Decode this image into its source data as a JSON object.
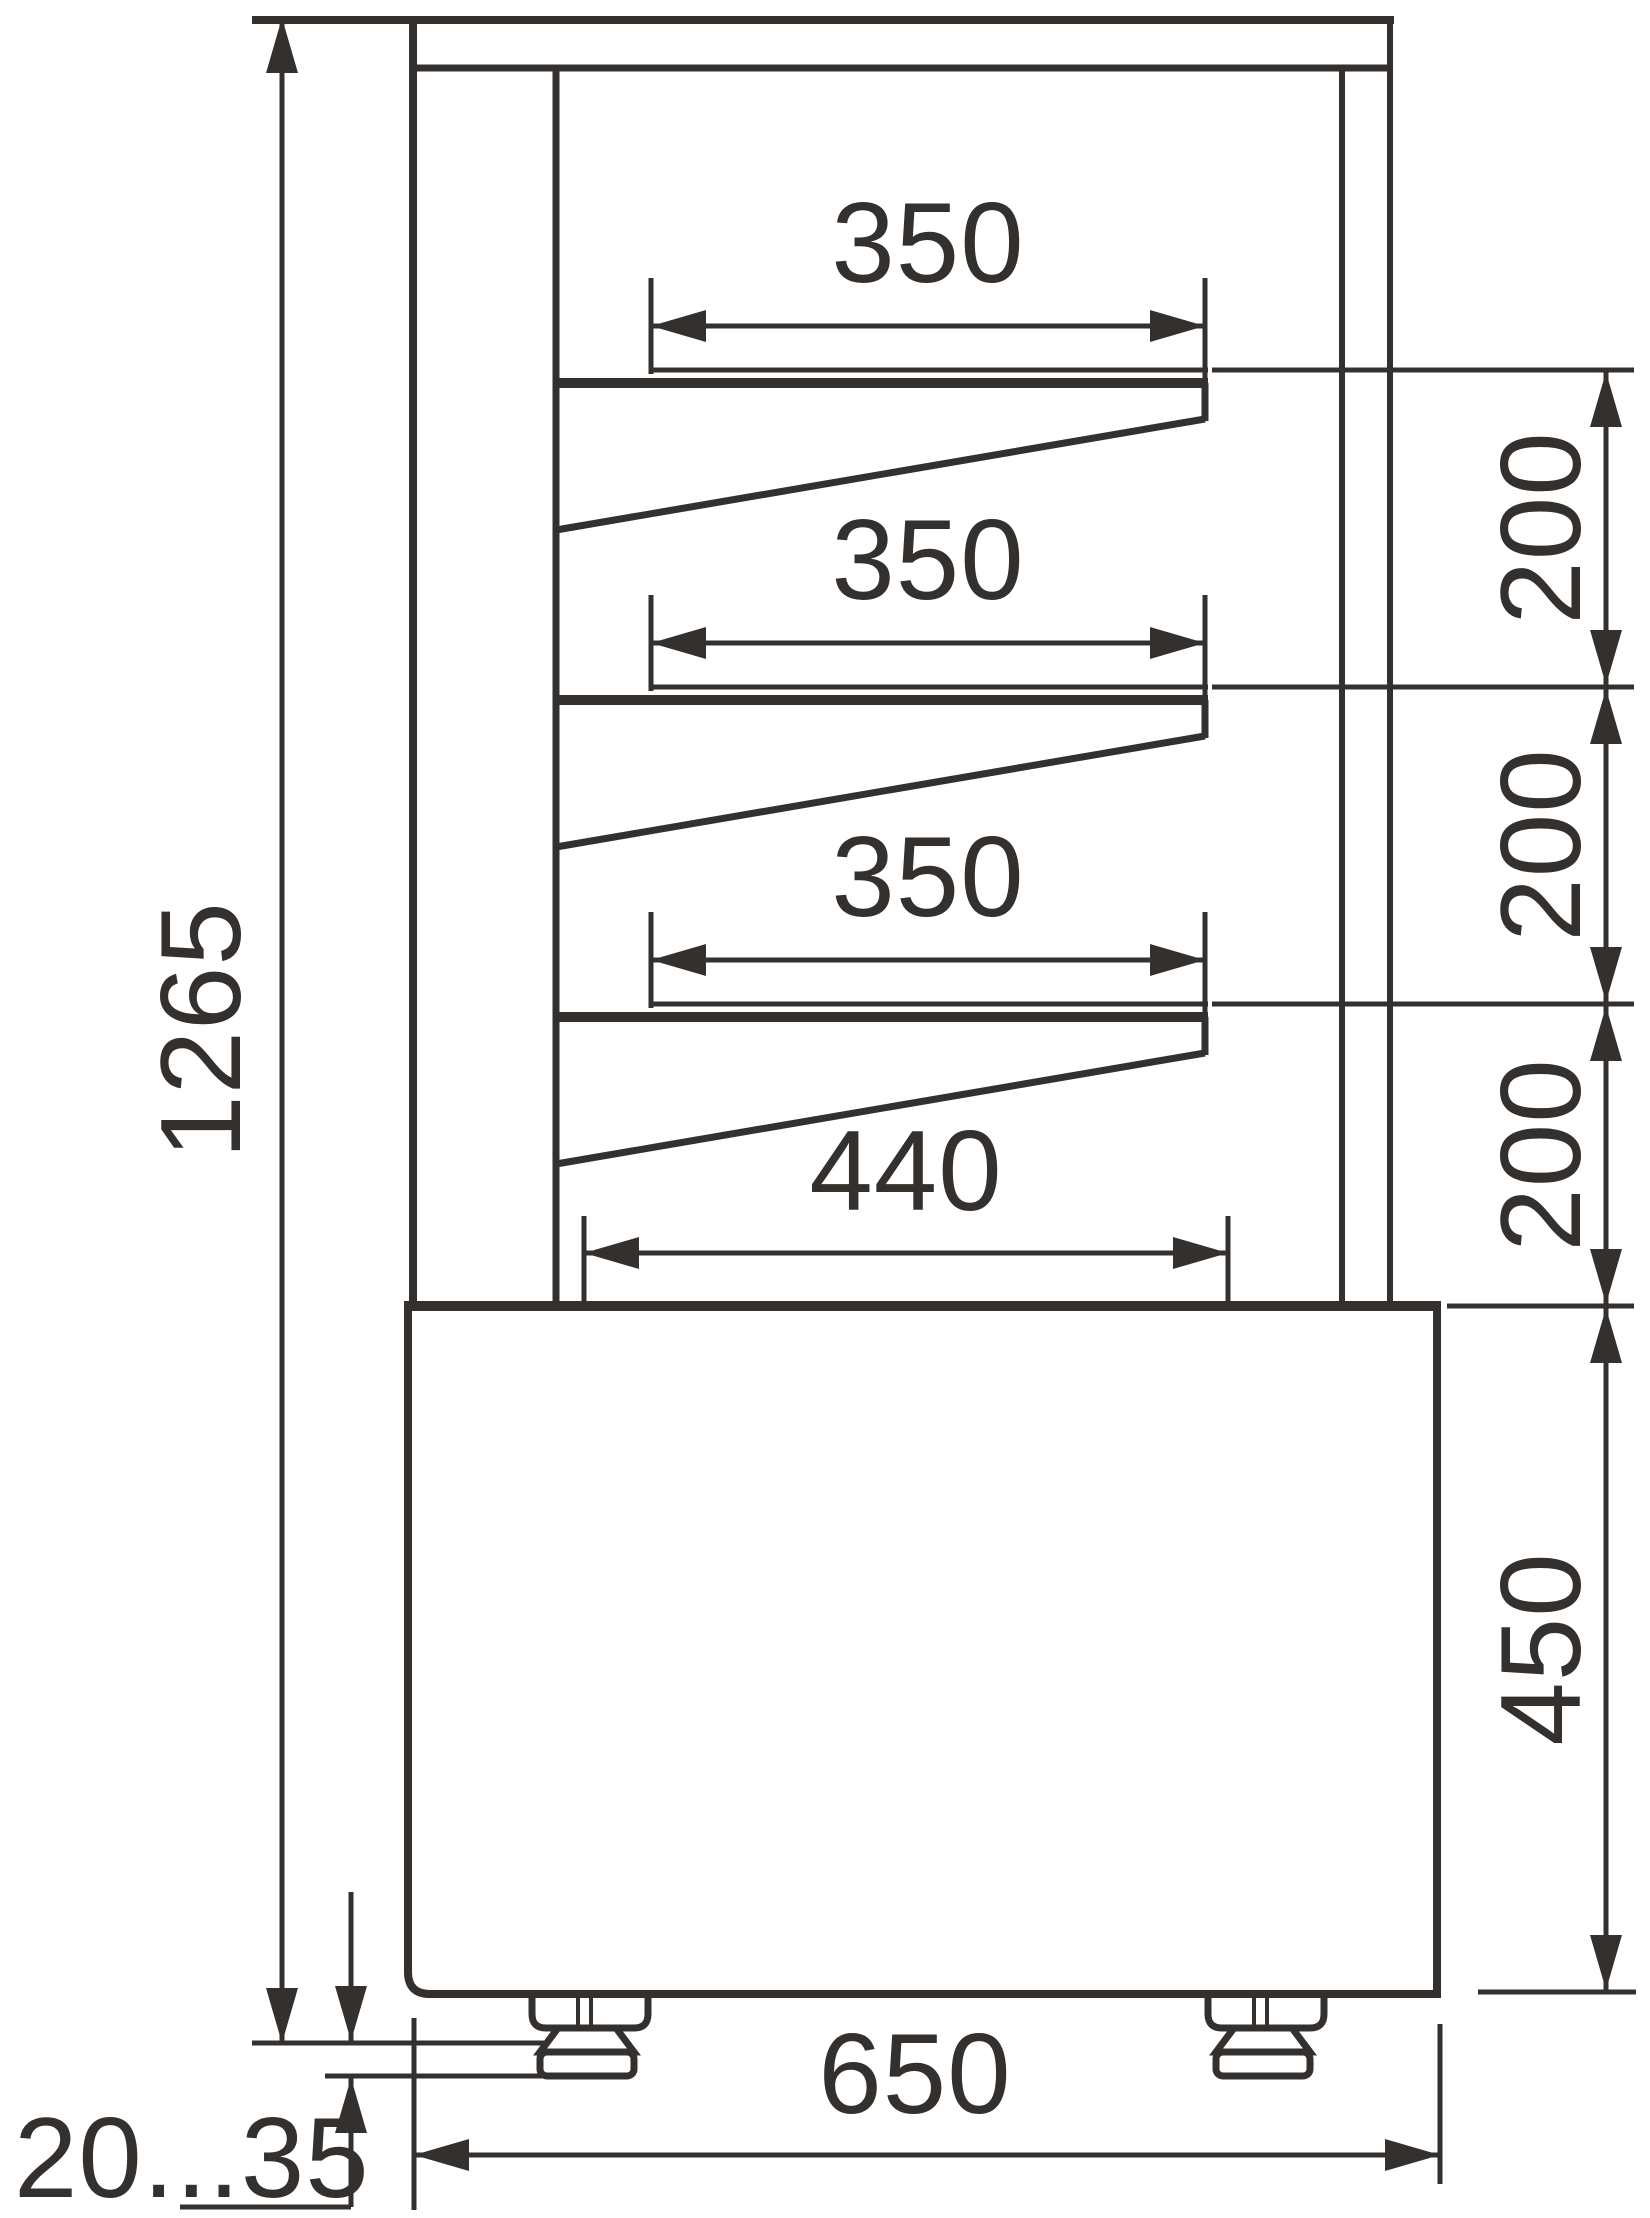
{
  "colors": {
    "ink": "#34302d",
    "background": "#ffffff"
  },
  "drawing": {
    "type": "technical-dimension-drawing",
    "subject": "refrigerated display case side view with shelf and base dimensions",
    "units": "mm",
    "dimensions": {
      "overall_height": {
        "label": "1265",
        "orientation": "vertical"
      },
      "shelf_depths": [
        {
          "label": "350",
          "orientation": "horizontal"
        },
        {
          "label": "350",
          "orientation": "horizontal"
        },
        {
          "label": "350",
          "orientation": "horizontal"
        }
      ],
      "shelf_spacings": [
        {
          "label": "200",
          "orientation": "vertical"
        },
        {
          "label": "200",
          "orientation": "vertical"
        },
        {
          "label": "200",
          "orientation": "vertical"
        }
      ],
      "bottom_shelf_depth": {
        "label": "440",
        "orientation": "horizontal"
      },
      "base_height": {
        "label": "450",
        "orientation": "vertical"
      },
      "base_depth": {
        "label": "650",
        "orientation": "horizontal"
      },
      "foot_adjustment_range": {
        "label": "20...35",
        "orientation": "vertical"
      }
    }
  }
}
